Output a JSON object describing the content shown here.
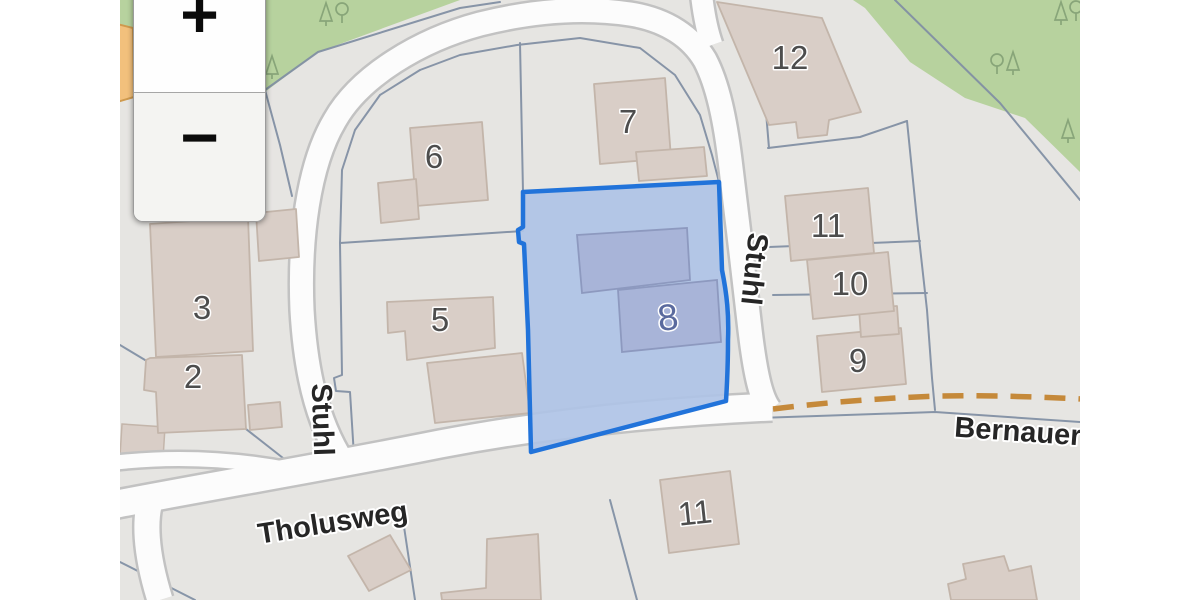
{
  "zoom_control": {
    "zoom_in_label": "+",
    "zoom_out_label": "−"
  },
  "streets": {
    "stuhl_left": "Stuhl",
    "stuhl_right": "Stuhl",
    "tholusweg": "Tholusweg",
    "bernauer": "Bernauer"
  },
  "house_numbers": {
    "b2": "2",
    "b3": "3",
    "b5": "5",
    "b6": "6",
    "b7": "7",
    "b8": "8",
    "b9": "9",
    "b10": "10",
    "b11_east": "11",
    "b11_south": "11",
    "b12": "12"
  },
  "selected_parcel": {
    "number": "8",
    "border_color": "#2173da",
    "fill_color": "#afc3e6"
  },
  "colors": {
    "map_background": "#e6e5e2",
    "road_fill": "#fcfcfc",
    "road_casing": "#c2c2c2",
    "building_fill": "#d9cec7",
    "building_outline": "#c3b5aa",
    "selected_building_fill": "#a8b4d8",
    "boundary_line": "#8290a4",
    "green_area": "#b7d29e",
    "track_dashed": "#c5893a",
    "minor_road_orange": "#f2c07c"
  }
}
